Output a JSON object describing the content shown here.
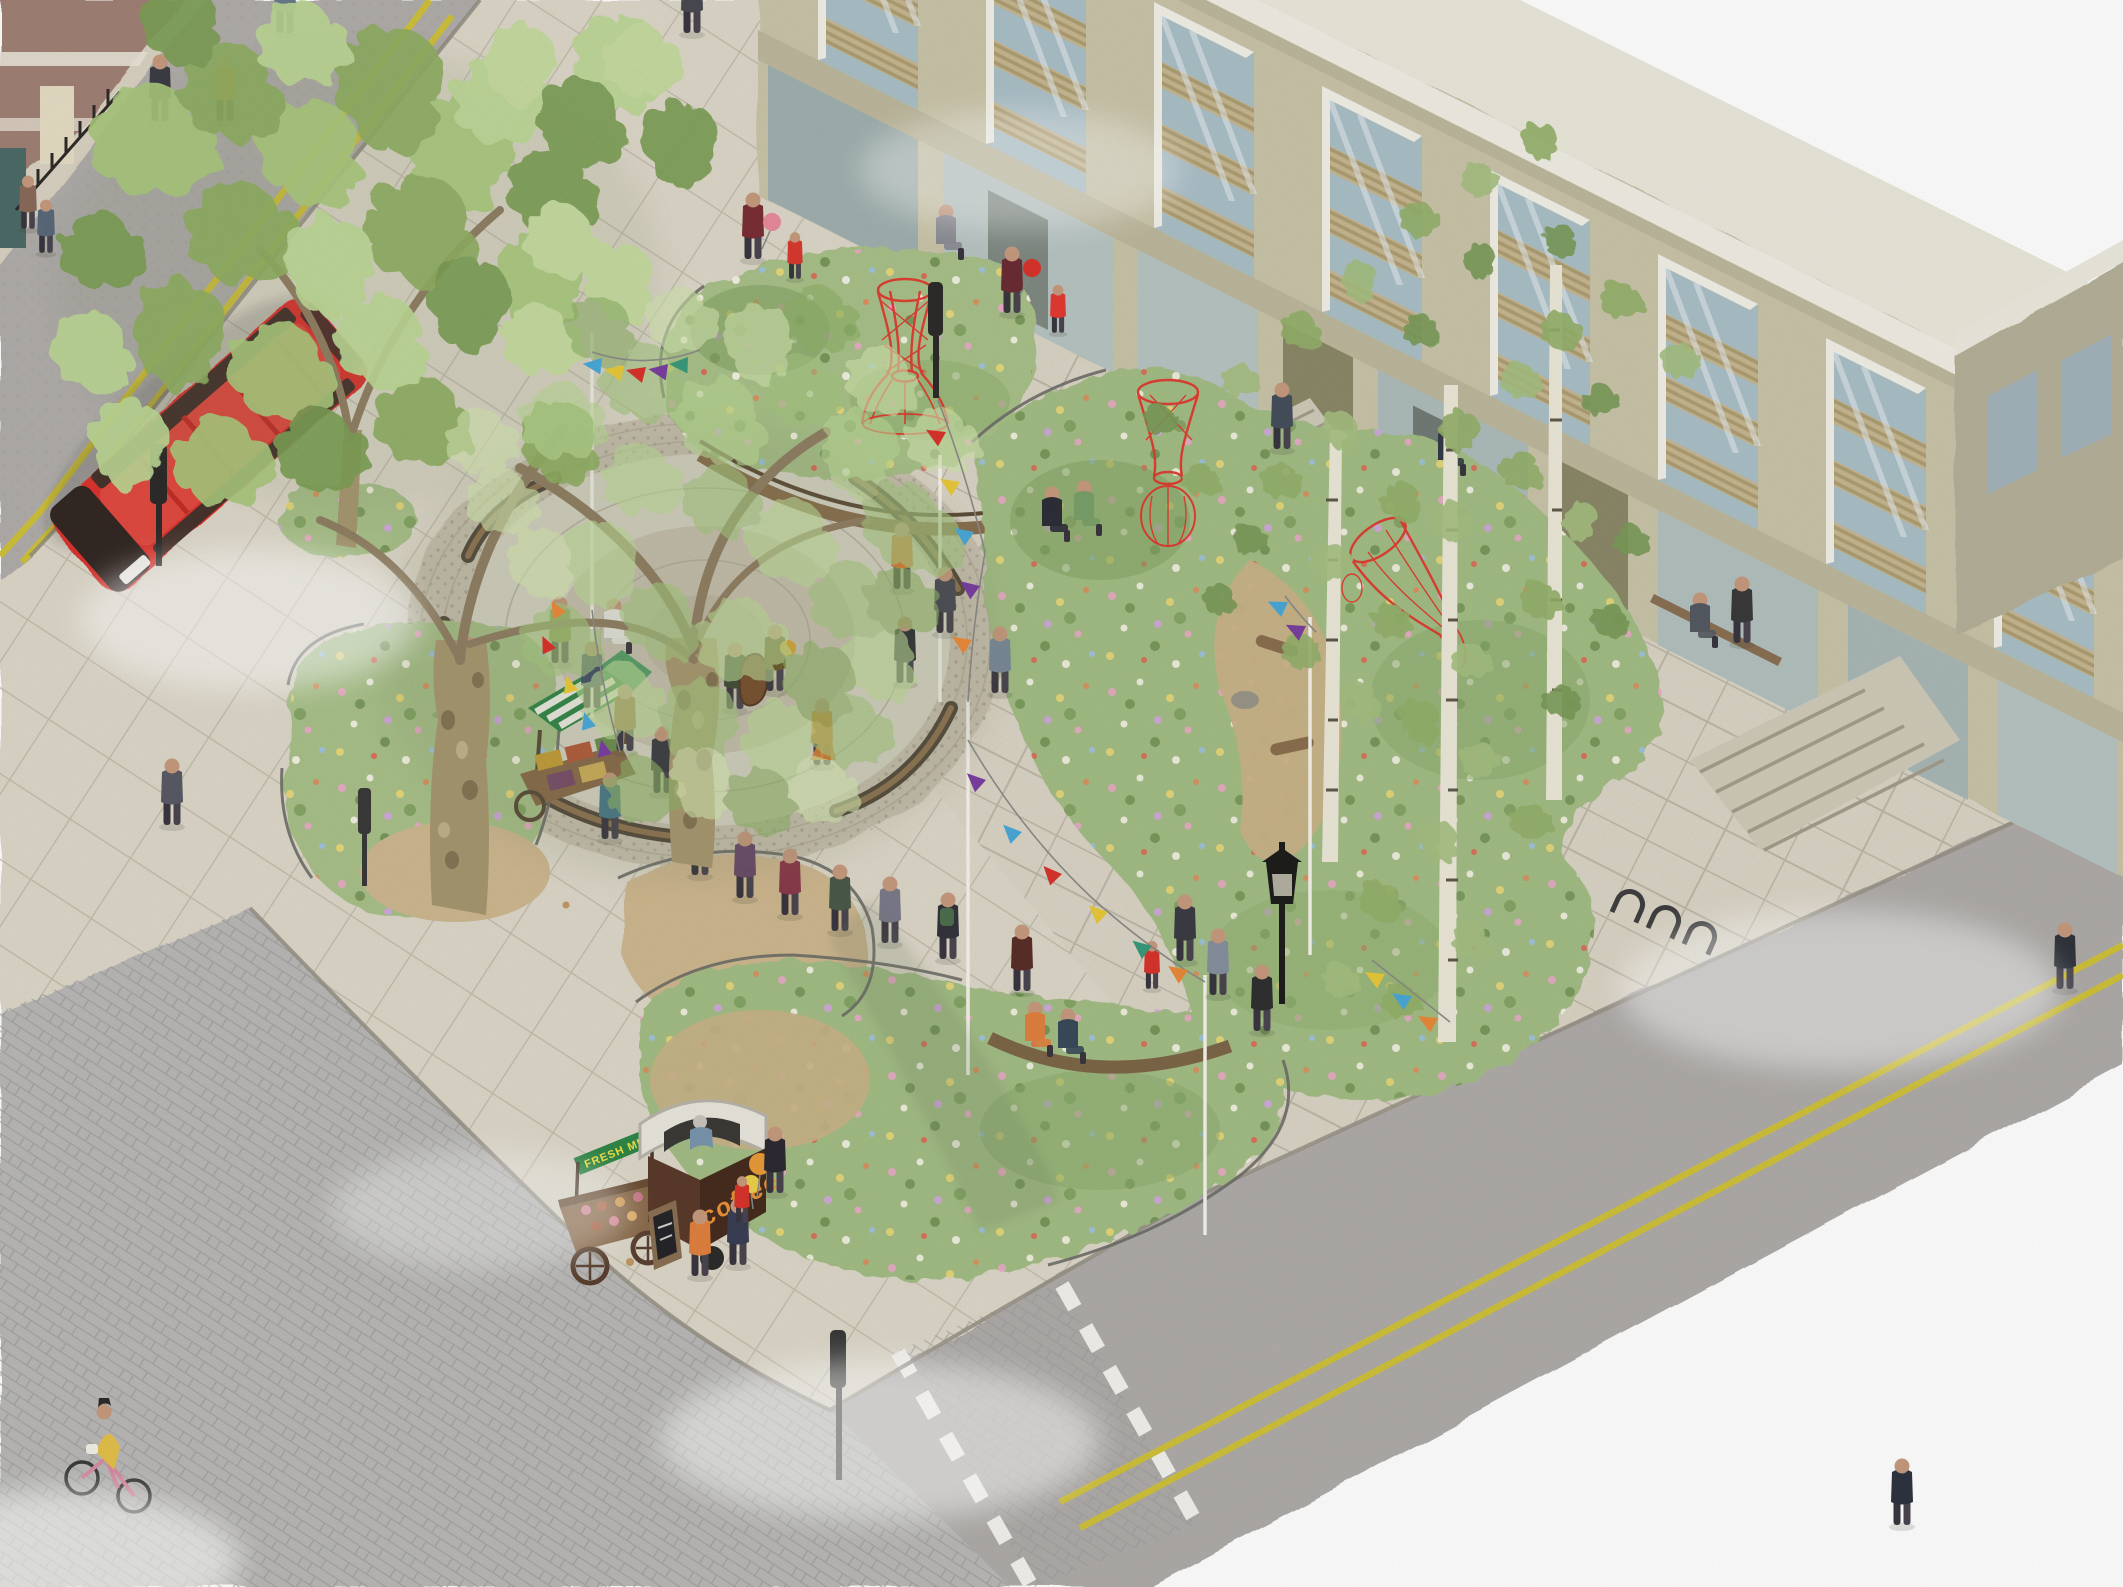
{
  "scene": {
    "type": "watercolour axonometric urban design illustration",
    "subject": "pocket-park square with circular plaza, wildflower planters, red wire sculptures, market carts, street trees and a red double-decker bus"
  },
  "signs": {
    "coffee_cart": "coffee",
    "market_banner": "FRESH MEAT"
  },
  "palette": {
    "paper": "#ffffff",
    "plaza_paving": "#dcd7c8",
    "paving_joint": "#b9b2a2",
    "asphalt": "#b0adaa",
    "setts": "#b9b8b6",
    "yellow_line": "#cfc13a",
    "brick_building": "#a08074",
    "building_facade": "#c9c4a8",
    "building_side": "#b5b098",
    "parapet": "#f0eee3",
    "window_glass": "#aabfc7",
    "window_louvre": "#c6b790",
    "foliage_greens": [
      "#a9c77d",
      "#8fae63",
      "#bcd795",
      "#7d9f55"
    ],
    "birch_foliage": "#94b06b",
    "tree_trunk": "#a5976f",
    "planting_bed": "#a8c089",
    "flower_pink": "#eaaac6",
    "flower_yellow": "#e8d878",
    "flower_white": "#f4f2e4",
    "bus_red": "#db352f",
    "sculpture_red": "#e0392f",
    "bench_wood": "#8a7054",
    "bench_dark": "#55493c",
    "bunting": [
      "#7a3fa0",
      "#4aa8d8",
      "#d8342c",
      "#e8c83a",
      "#e8893a",
      "#3a9a7a"
    ],
    "coffee_cart_body": "#4a2f22",
    "coffee_text": "#e8923a",
    "banner_green": "#2f8747",
    "banner_text": "#f2e14a"
  }
}
